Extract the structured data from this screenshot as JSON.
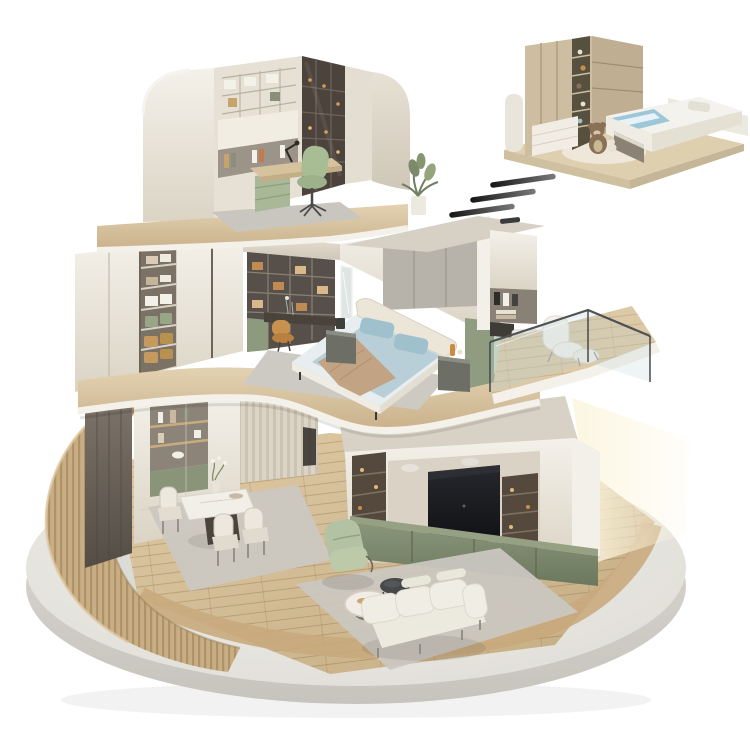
{
  "scene": {
    "type": "3d-isometric-home-cutaway-render",
    "platform": {
      "name": "circular-concrete-platform",
      "floor": "light-oak-plank-floor",
      "left_wall": "curved-wood-slat-wall",
      "right_wall": "curved-glass-wall"
    },
    "floors": [
      {
        "name": "top-floor-study",
        "items": [
          "curved-cream-side-walls",
          "built-in-shelving-wall",
          "white-storage-boxes",
          "desk-with-lamp-and-laptop",
          "green-cabinet",
          "green-office-chair",
          "dark-glass-door-bookcase",
          "gray-area-rug",
          "potted-plant"
        ]
      },
      {
        "name": "middle-floor-bedroom",
        "items": [
          "white-wardrobe-wall",
          "open-wardrobe-bay-with-folded-clothes",
          "storage-baskets",
          "green-drawers",
          "vanity-desk-nook-with-shelving",
          "caramel-chair",
          "floor-mirror",
          "double-bed",
          "blue-bedding",
          "tan-throw-blanket",
          "cream-headboard",
          "gray-fabric-wall-panels",
          "two-nightstands",
          "laundry-nook",
          "hanging-towels",
          "washing-machine",
          "sage-cabinet",
          "glass-railing-balcony",
          "white-lounge-chair-and-ottoman"
        ]
      },
      {
        "name": "ground-floor-living-dining",
        "items": [
          "dark-wood-divider-panel",
          "sideboard-display-shelves",
          "green-accent-panel",
          "dining-table-marble-top",
          "dining-chairs",
          "flower-vase",
          "dining-rug",
          "tv-media-wall",
          "flat-screen-tv",
          "lit-display-shelf-columns",
          "olive-media-cabinet",
          "sage-recliner-armchair",
          "round-marble-coffee-table",
          "smoked-glass-side-table",
          "three-seat-white-sofa",
          "living-area-rug"
        ]
      }
    ],
    "detail_vignette": {
      "name": "kids-bedroom-closeup",
      "position": "top-right",
      "items": [
        "wood-wardrobe-with-display-column",
        "teddy-bear-toys",
        "white-platform-bed",
        "blue-blanket",
        "floor-teddy-bear",
        "round-cream-rug",
        "wood-base-slab",
        "small-curved-wall"
      ]
    },
    "motion_dashes": {
      "count": 3
    }
  },
  "palette": {
    "bg": "#ffffff",
    "platformTop": "#eae8e3",
    "platformSide": "#d8d6cf",
    "woodFloor": "#d5c09a",
    "woodRing": "#c9aa7e",
    "slatWood": "#c8b088",
    "slabWood": "#dcc9a7",
    "slabTrim": "#f4f1ea",
    "creamWall": "#e9e3d8",
    "creamBright": "#f3f0e9",
    "darkWoodPanel": "#6e665c",
    "shelfDark": "#55493d",
    "amber": "#c98f4e",
    "oliveCabinet": "#7e8a6d",
    "sageGreen": "#b3c2a2",
    "mintCabinet": "#c6d6bd",
    "bedroomGreenWall": "#8f9c80",
    "bedBlue": "#b9cfd8",
    "pillowBlue": "#9fc0cd",
    "blanketTan": "#c2a384",
    "bedCream": "#ece6d9",
    "headboardGray": "#b7b3ab",
    "tvScreen": "#17181b",
    "chairMustard": "#c8914f",
    "rugGray": "#cbc8c1",
    "glassTint": "rgba(188,207,211,0.30)",
    "glassRail": "#4e5254",
    "warmGlow": "#fcf6e0",
    "dashDark": "#1c1c1c",
    "teddyBrown": "#8a7054",
    "vignetteWood": "#cdbda1"
  }
}
